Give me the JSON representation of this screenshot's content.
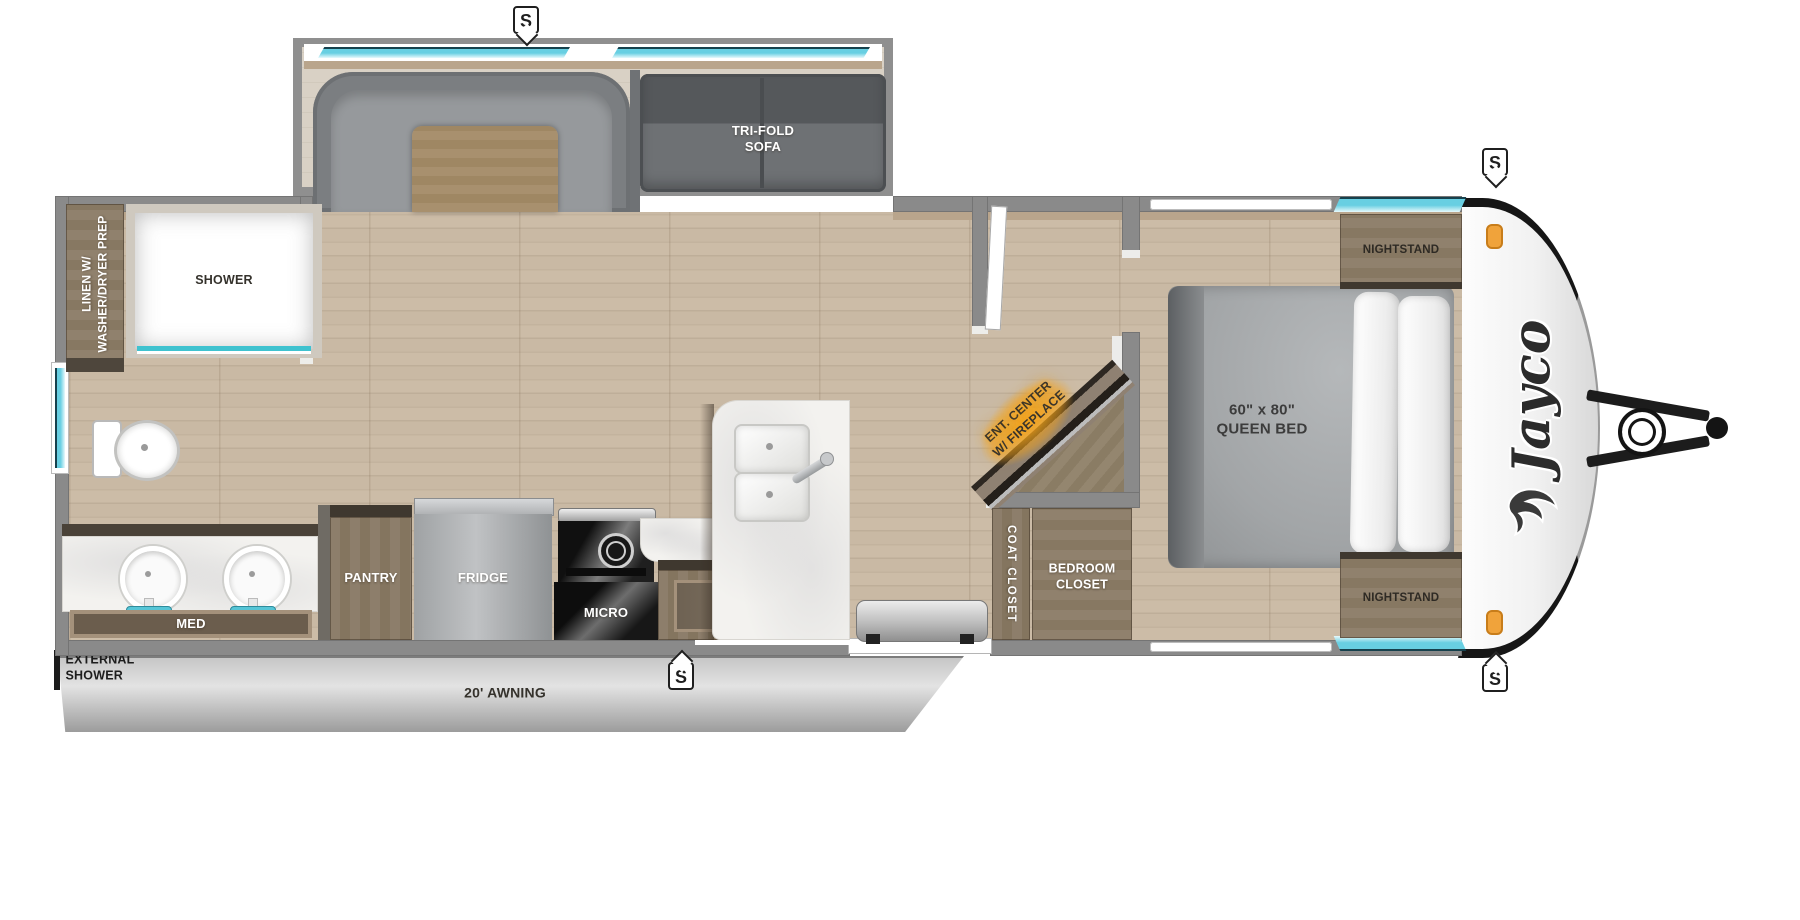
{
  "brand": "Jayco",
  "speaker_marker": "S",
  "slideout": {
    "sofa": "TRI-FOLD\nSOFA"
  },
  "bathroom": {
    "linen": "LINEN W/\nWASHER/DRYER PREP",
    "shower": "SHOWER",
    "med": "MED"
  },
  "kitchen": {
    "pantry": "PANTRY",
    "fridge": "FRIDGE",
    "micro": "MICRO",
    "ohc": "OHC"
  },
  "living": {
    "ent_center": "ENT. CENTER\nW/ FIREPLACE"
  },
  "closets": {
    "coat": "COAT CLOSET",
    "bedroom": "BEDROOM\nCLOSET"
  },
  "bedroom": {
    "bed": "60\" x 80\"\nQUEEN BED",
    "nightstand_top": "NIGHTSTAND",
    "nightstand_bottom": "NIGHTSTAND"
  },
  "exterior": {
    "external_shower": "EXTERNAL\nSHOWER",
    "awning": "20' AWNING"
  },
  "colors": {
    "window_cyan": "#68cfe2",
    "fireplace_glow": "#f5a623",
    "wall_gray": "#8a8a8a",
    "cabinet_wood": "#8b7c6a",
    "floor_wood": "#c9b9a4",
    "clearance_light_orange": "#f0a33b"
  }
}
